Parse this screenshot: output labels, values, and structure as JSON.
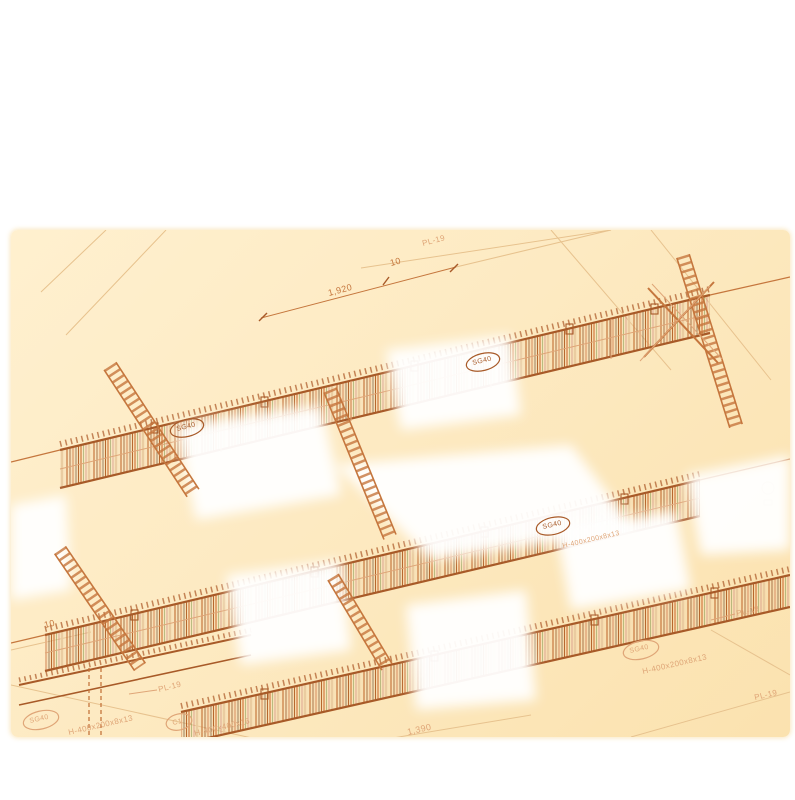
{
  "colors": {
    "line": "#c5763d",
    "line-dark": "#a85a28",
    "line-light": "#dfa577",
    "faint": "#e7c28e",
    "bg-top": "#fff0cf",
    "bg-bottom": "#fbe2af",
    "white-bloom": "#ffffff"
  },
  "labels": {
    "pl19_top": "PL-19",
    "pl19_right": "PL-19",
    "pl19_right_lower": "PL-19",
    "pl19_bottom": "PL-19",
    "dim_1920": "1,920",
    "dim_10": "10",
    "dim_10b": "10",
    "dim_1390": "1,390",
    "tag_girder_left": "SG40",
    "tag_girder_right": "SG40",
    "tag_girder_mid": "SG40",
    "tag_bottom_left": "SG40",
    "tag_bottom_right": "SG40",
    "tag_column": "C1",
    "spec_bottom_left": "H-400x200x8x13",
    "spec_bottom_right": "H-400x200x8x13",
    "spec_mid": "H-400x200x8x13",
    "spec_column": "H-400x400x16"
  }
}
